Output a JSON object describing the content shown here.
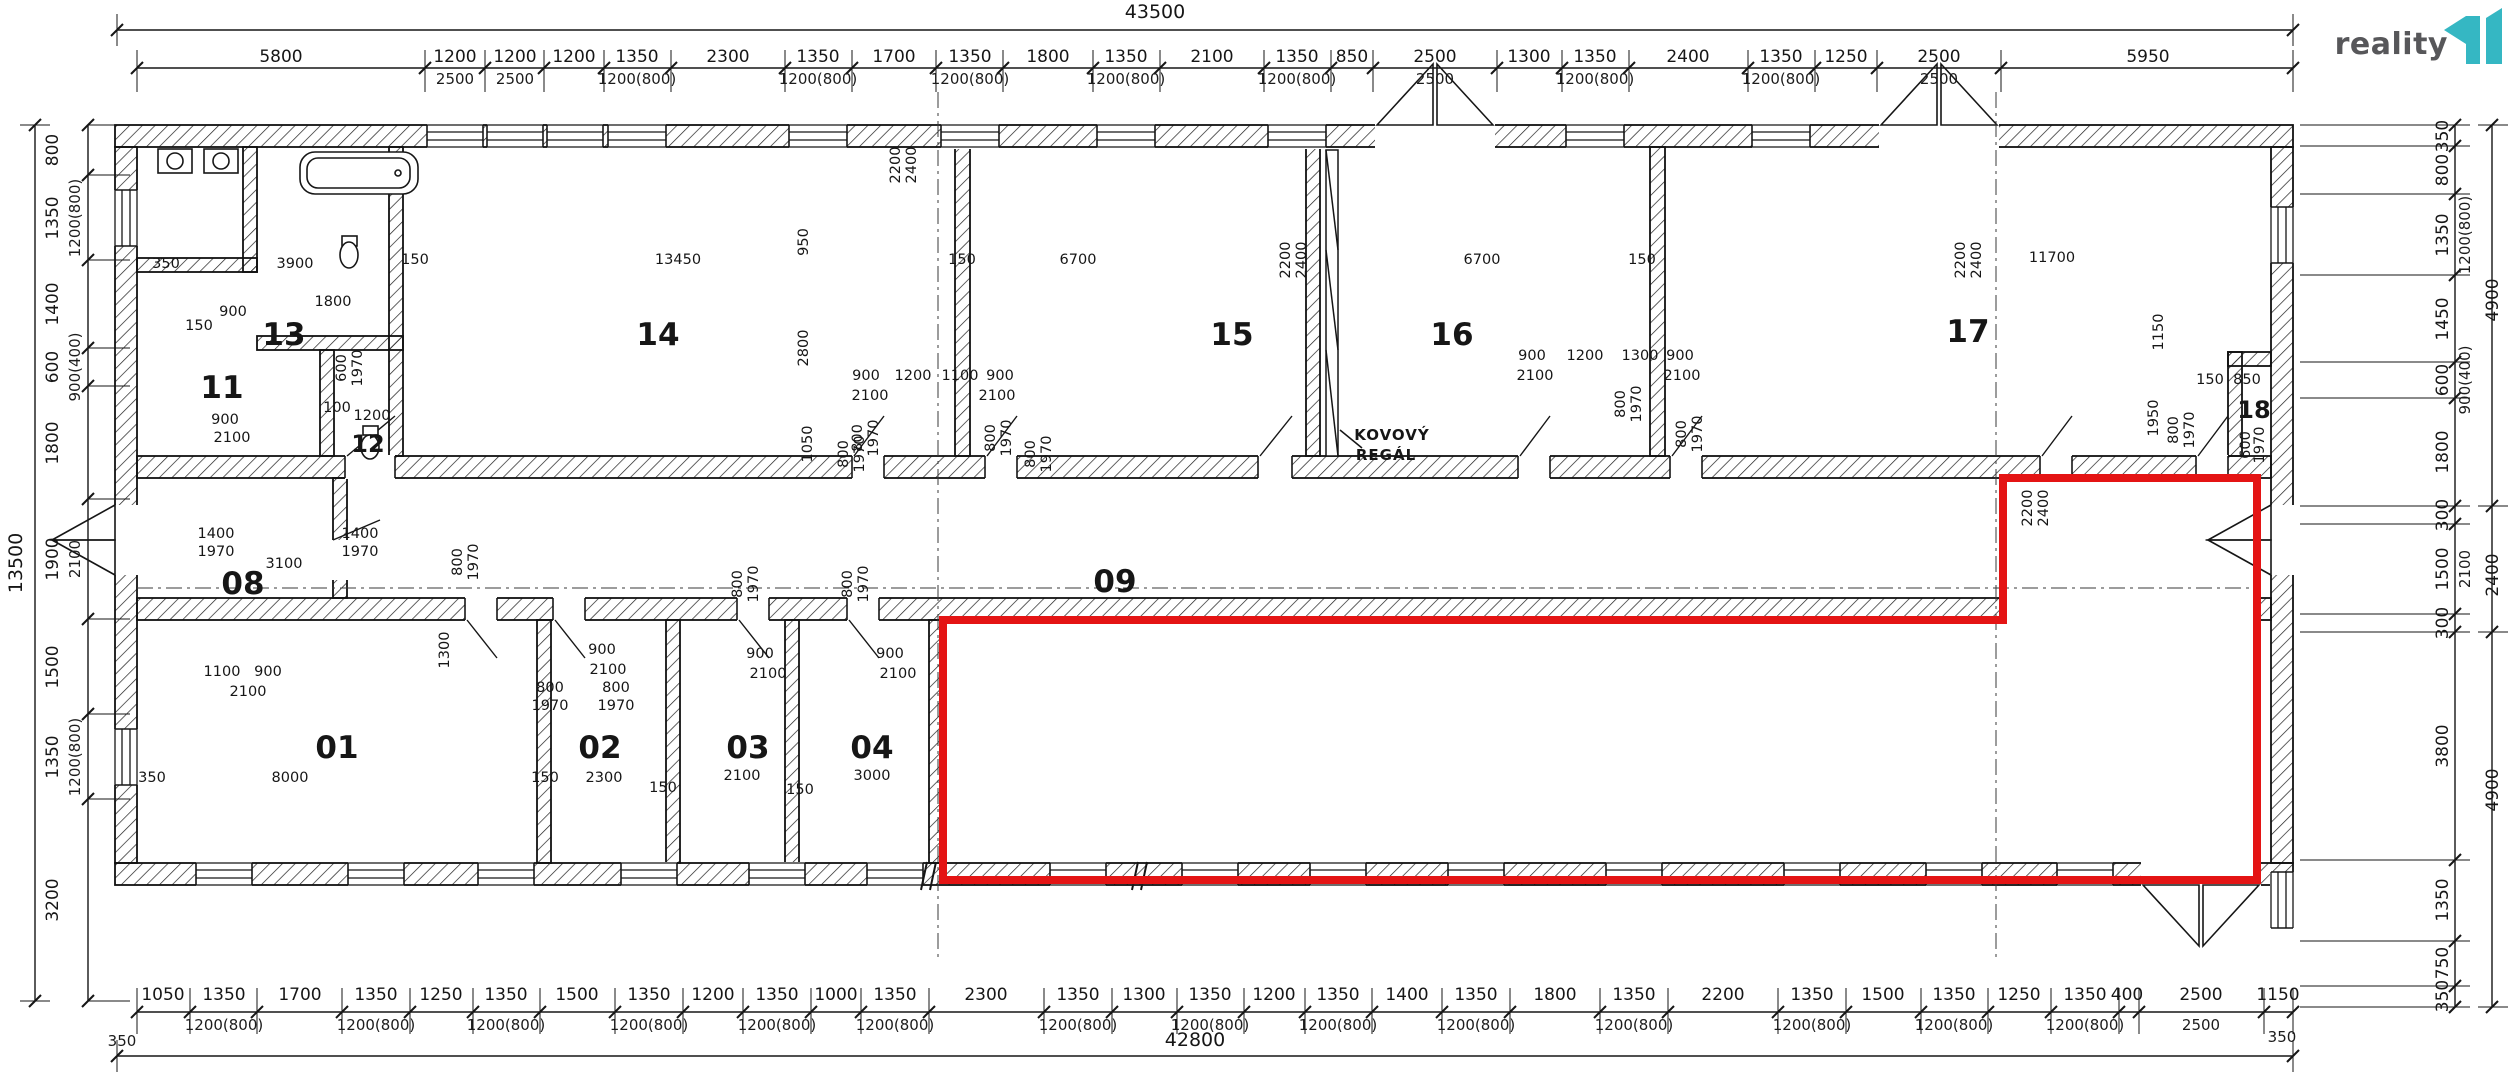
{
  "logo": {
    "text": "reality",
    "mark": "11",
    "color": "#35b7c3",
    "text_color": "#57575a"
  },
  "plan": {
    "highlight_color": "#e41414",
    "ink_color": "#161616"
  },
  "totals": {
    "top": "43500",
    "bottom": "42800",
    "left": "13500"
  },
  "annotations": [
    [
      "KOVOVÝ",
      1392,
      440
    ],
    [
      "REGÁL",
      1386,
      460
    ]
  ],
  "rooms": [
    [
      "01",
      337,
      758
    ],
    [
      "02",
      600,
      758
    ],
    [
      "03",
      748,
      758
    ],
    [
      "04",
      872,
      758
    ],
    [
      "08",
      243,
      594
    ],
    [
      "09",
      1115,
      592
    ],
    [
      "11",
      222,
      398
    ],
    [
      "12",
      368,
      452,
      1
    ],
    [
      "13",
      284,
      345
    ],
    [
      "14",
      658,
      345
    ],
    [
      "15",
      1232,
      345
    ],
    [
      "16",
      1452,
      345
    ],
    [
      "17",
      1968,
      342
    ],
    [
      "18",
      2254,
      418,
      1
    ]
  ],
  "top_chain": {
    "main": [
      [
        "5800",
        281
      ],
      [
        "1200",
        455
      ],
      [
        "1200",
        515
      ],
      [
        "1200",
        574
      ],
      [
        "1350",
        637
      ],
      [
        "2300",
        728
      ],
      [
        "1350",
        818
      ],
      [
        "1700",
        894
      ],
      [
        "1350",
        970
      ],
      [
        "1800",
        1048
      ],
      [
        "1350",
        1126
      ],
      [
        "2100",
        1212
      ],
      [
        "1350",
        1297
      ],
      [
        "850",
        1352
      ],
      [
        "2500",
        1435
      ],
      [
        "1300",
        1529
      ],
      [
        "1350",
        1595
      ],
      [
        "2400",
        1688
      ],
      [
        "1350",
        1781
      ],
      [
        "1250",
        1846
      ],
      [
        "2500",
        1939
      ],
      [
        "5950",
        2148
      ]
    ],
    "sub": [
      [
        "2500",
        455
      ],
      [
        "2500",
        515
      ],
      [
        "1200(800)",
        637
      ],
      [
        "1200(800)",
        818
      ],
      [
        "1200(800)",
        970
      ],
      [
        "1200(800)",
        1126
      ],
      [
        "1200(800)",
        1297
      ],
      [
        "2500",
        1435
      ],
      [
        "1200(800)",
        1595
      ],
      [
        "1200(800)",
        1781
      ],
      [
        "2500",
        1939
      ]
    ]
  },
  "bottom_chain": {
    "main": [
      [
        "1050",
        163
      ],
      [
        "1350",
        224
      ],
      [
        "1700",
        300
      ],
      [
        "1350",
        376
      ],
      [
        "1250",
        441
      ],
      [
        "1350",
        506
      ],
      [
        "1500",
        577
      ],
      [
        "1350",
        649
      ],
      [
        "1200",
        713
      ],
      [
        "1350",
        777
      ],
      [
        "1000",
        836
      ],
      [
        "1350",
        895
      ],
      [
        "2300",
        986
      ],
      [
        "1350",
        1078
      ],
      [
        "1300",
        1144
      ],
      [
        "1350",
        1210
      ],
      [
        "1200",
        1274
      ],
      [
        "1350",
        1338
      ],
      [
        "1400",
        1407
      ],
      [
        "1350",
        1476
      ],
      [
        "1800",
        1555
      ],
      [
        "1350",
        1634
      ],
      [
        "2200",
        1723
      ],
      [
        "1350",
        1812
      ],
      [
        "1500",
        1883
      ],
      [
        "1350",
        1954
      ],
      [
        "1250",
        2019
      ],
      [
        "1350",
        2085
      ],
      [
        "400",
        2127
      ],
      [
        "2500",
        2201
      ],
      [
        "1150",
        2278
      ]
    ],
    "sub": [
      [
        "1200(800)",
        224
      ],
      [
        "1200(800)",
        376
      ],
      [
        "1200(800)",
        506
      ],
      [
        "1200(800)",
        649
      ],
      [
        "1200(800)",
        777
      ],
      [
        "1200(800)",
        895
      ],
      [
        "1200(800)",
        1078
      ],
      [
        "1200(800)",
        1210
      ],
      [
        "1200(800)",
        1338
      ],
      [
        "1200(800)",
        1476
      ],
      [
        "1200(800)",
        1634
      ],
      [
        "1200(800)",
        1812
      ],
      [
        "1200(800)",
        1954
      ],
      [
        "1200(800)",
        2085
      ],
      [
        "2500",
        2201
      ]
    ],
    "extra": [
      [
        "350",
        122,
        1046
      ],
      [
        "350",
        2282,
        1042
      ]
    ]
  },
  "left_chain": {
    "main": [
      [
        "800",
        150
      ],
      [
        "1350",
        218
      ],
      [
        "1400",
        304
      ],
      [
        "600",
        367
      ],
      [
        "1800",
        443
      ],
      [
        "1900",
        559
      ],
      [
        "1500",
        667
      ],
      [
        "1350",
        757
      ],
      [
        "3200",
        900
      ]
    ],
    "sub": [
      [
        "1200(800)",
        218
      ],
      [
        "900(400)",
        367
      ],
      [
        "2100",
        559
      ],
      [
        "1200(800)",
        757
      ]
    ]
  },
  "right_chain": {
    "main": [
      [
        "350",
        136
      ],
      [
        "800",
        170
      ],
      [
        "1350",
        235
      ],
      [
        "1450",
        319
      ],
      [
        "600",
        380
      ],
      [
        "1800",
        452
      ],
      [
        "300",
        515
      ],
      [
        "1500",
        569
      ],
      [
        "300",
        623
      ],
      [
        "3800",
        746
      ],
      [
        "1350",
        900
      ],
      [
        "750",
        963
      ],
      [
        "350",
        996
      ]
    ],
    "sub": [
      [
        "1200(800)",
        235
      ],
      [
        "900(400)",
        380
      ],
      [
        "2100",
        569
      ]
    ],
    "outer": [
      [
        "4900",
        300
      ],
      [
        "2400",
        575
      ],
      [
        "4900",
        790
      ]
    ]
  },
  "dims": [
    [
      "350",
      166,
      268
    ],
    [
      "3900",
      295,
      268
    ],
    [
      "150",
      415,
      264
    ],
    [
      "13450",
      678,
      264
    ],
    [
      "950",
      808,
      242,
      1
    ],
    [
      "150",
      962,
      264
    ],
    [
      "6700",
      1078,
      264
    ],
    [
      "2800",
      808,
      348,
      1
    ],
    [
      "6700",
      1482,
      264
    ],
    [
      "150",
      1642,
      264
    ],
    [
      "11700",
      2052,
      262
    ],
    [
      "1800",
      333,
      306
    ],
    [
      "900",
      233,
      316
    ],
    [
      "150",
      199,
      330
    ],
    [
      "1200",
      372,
      420
    ],
    [
      "100",
      337,
      412
    ],
    [
      "900",
      225,
      424
    ],
    [
      "2100",
      232,
      442
    ],
    [
      "600",
      346,
      368,
      1
    ],
    [
      "1970",
      362,
      368,
      1
    ],
    [
      "900",
      866,
      380
    ],
    [
      "1200",
      913,
      380
    ],
    [
      "1100",
      960,
      380
    ],
    [
      "900",
      1000,
      380
    ],
    [
      "2100",
      870,
      400
    ],
    [
      "2100",
      997,
      400
    ],
    [
      "800",
      862,
      438,
      1
    ],
    [
      "1970",
      878,
      438,
      1
    ],
    [
      "800",
      995,
      438,
      1
    ],
    [
      "1970",
      1011,
      438,
      1
    ],
    [
      "1050",
      812,
      444,
      1
    ],
    [
      "900",
      1532,
      360
    ],
    [
      "1200",
      1585,
      360
    ],
    [
      "1300",
      1640,
      360
    ],
    [
      "900",
      1680,
      360
    ],
    [
      "2100",
      1535,
      380
    ],
    [
      "2100",
      1682,
      380
    ],
    [
      "800",
      1625,
      404,
      1
    ],
    [
      "1970",
      1641,
      404,
      1
    ],
    [
      "800",
      1686,
      434,
      1
    ],
    [
      "1970",
      1702,
      434,
      1
    ],
    [
      "2200",
      900,
      165,
      1
    ],
    [
      "2400",
      916,
      165,
      1
    ],
    [
      "2200",
      1290,
      260,
      1
    ],
    [
      "2400",
      1306,
      260,
      1
    ],
    [
      "2200",
      1965,
      260,
      1
    ],
    [
      "2400",
      1981,
      260,
      1
    ],
    [
      "1150",
      2163,
      332,
      1
    ],
    [
      "1950",
      2158,
      418,
      1
    ],
    [
      "800",
      2178,
      430,
      1
    ],
    [
      "1970",
      2194,
      430,
      1
    ],
    [
      "150",
      2210,
      384
    ],
    [
      "850",
      2247,
      384
    ],
    [
      "600",
      2250,
      445,
      1
    ],
    [
      "1970",
      2264,
      445,
      1
    ],
    [
      "1400",
      216,
      538
    ],
    [
      "1970",
      216,
      556
    ],
    [
      "1400",
      360,
      538
    ],
    [
      "1970",
      360,
      556
    ],
    [
      "3100",
      284,
      568
    ],
    [
      "800",
      462,
      562,
      1
    ],
    [
      "1970",
      478,
      562,
      1
    ],
    [
      "800",
      848,
      454,
      1
    ],
    [
      "1970",
      864,
      454,
      1
    ],
    [
      "800",
      1035,
      454,
      1
    ],
    [
      "1970",
      1051,
      454,
      1
    ],
    [
      "2200",
      2032,
      508,
      1
    ],
    [
      "2400",
      2048,
      508,
      1
    ],
    [
      "1100",
      222,
      676
    ],
    [
      "900",
      268,
      676
    ],
    [
      "2100",
      248,
      696
    ],
    [
      "1300",
      449,
      650,
      1
    ],
    [
      "900",
      602,
      654
    ],
    [
      "2100",
      608,
      674
    ],
    [
      "800",
      550,
      692
    ],
    [
      "1970",
      550,
      710
    ],
    [
      "800",
      616,
      692
    ],
    [
      "1970",
      616,
      710
    ],
    [
      "900",
      760,
      658
    ],
    [
      "2100",
      768,
      678
    ],
    [
      "900",
      890,
      658
    ],
    [
      "2100",
      898,
      678
    ],
    [
      "800",
      742,
      584,
      1
    ],
    [
      "1970",
      758,
      584,
      1
    ],
    [
      "800",
      852,
      584,
      1
    ],
    [
      "1970",
      868,
      584,
      1
    ],
    [
      "350",
      152,
      782
    ],
    [
      "8000",
      290,
      782
    ],
    [
      "150",
      545,
      782
    ],
    [
      "2300",
      604,
      782
    ],
    [
      "150",
      663,
      792
    ],
    [
      "2100",
      742,
      780
    ],
    [
      "150",
      800,
      794
    ],
    [
      "3000",
      872,
      780
    ]
  ]
}
